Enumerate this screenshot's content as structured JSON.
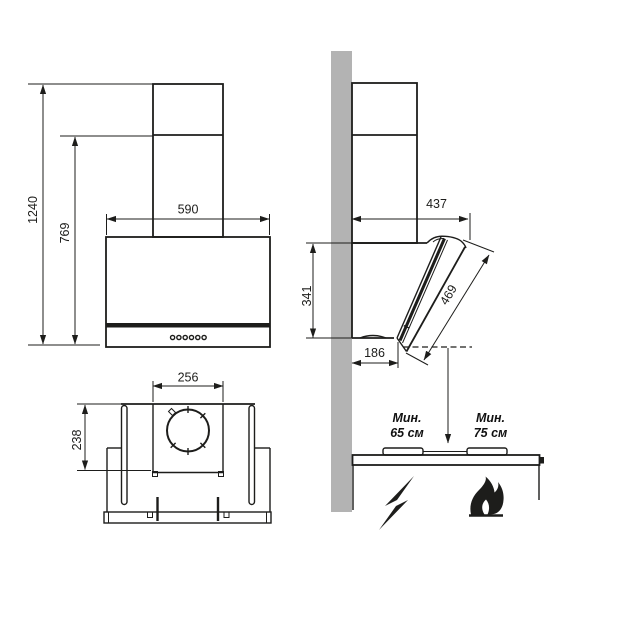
{
  "drawing": {
    "front": {
      "height_total": "1240",
      "height_lower": "769",
      "width": "590"
    },
    "side": {
      "depth_top": "437",
      "panel_length": "469",
      "body_height": "341",
      "depth_bottom": "186"
    },
    "top": {
      "duct_plate_width": "256",
      "mount_depth": "238"
    },
    "clearance_electric": {
      "l1": "Мин.",
      "l2": "65 см"
    },
    "clearance_gas": {
      "l1": "Мин.",
      "l2": "75 см"
    },
    "colors": {
      "wall": "#b3b3b3",
      "ink": "#1d1d1b"
    }
  }
}
